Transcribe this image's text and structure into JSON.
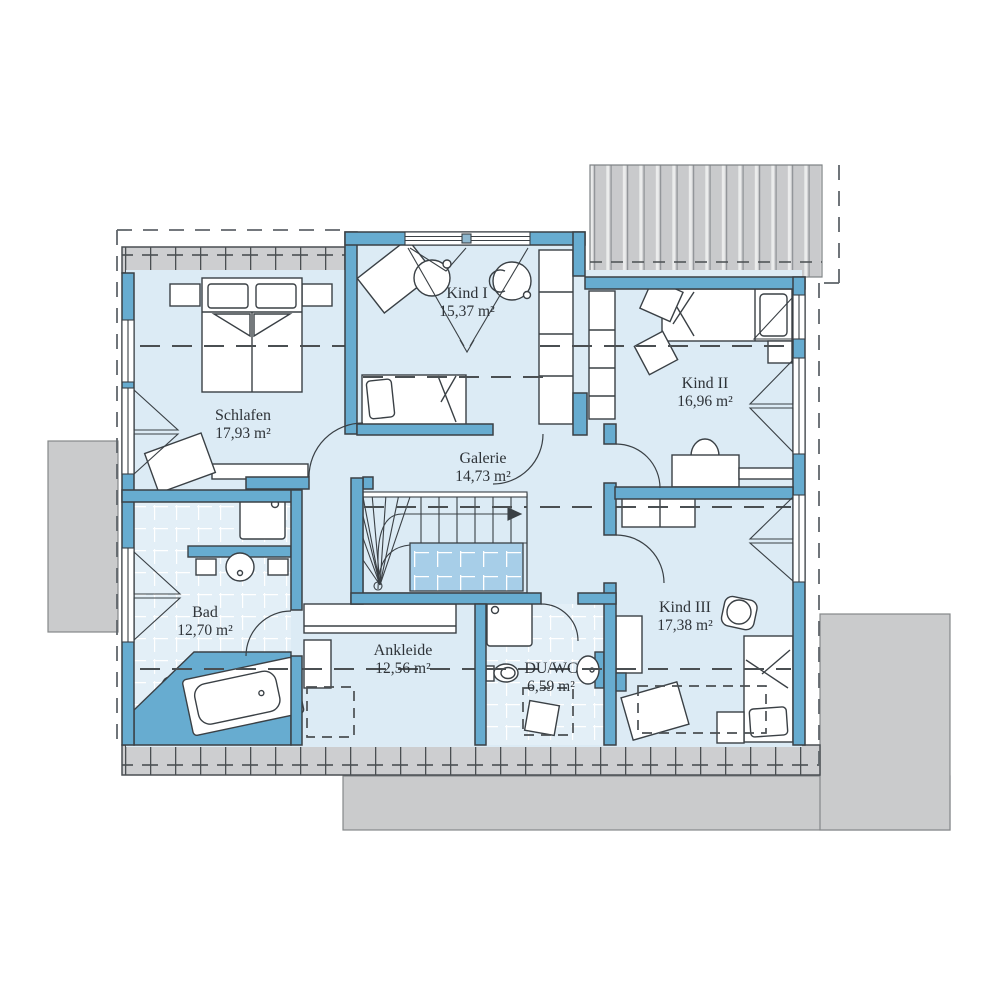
{
  "floorplan": {
    "rooms": {
      "schlafen": {
        "name": "Schlafen",
        "area": "17,93 m²"
      },
      "kind1": {
        "name": "Kind I",
        "area": "15,37 m²"
      },
      "kind2": {
        "name": "Kind II",
        "area": "16,96 m²"
      },
      "galerie": {
        "name": "Galerie",
        "area": "14,73 m²"
      },
      "bad": {
        "name": "Bad",
        "area": "12,70 m²"
      },
      "ankleide": {
        "name": "Ankleide",
        "area": "12,56 m²"
      },
      "duwc": {
        "name": "DU/WC",
        "area": "6,59 m²"
      },
      "kind3": {
        "name": "Kind III",
        "area": "17,38 m²"
      }
    },
    "colors": {
      "wall": "#67acd0",
      "room": "#dcebf5",
      "tile_room": "#e3eff7",
      "stair_landing": "#a7cee8",
      "roof_gray": "#cacbcc",
      "outline": "#3a4045"
    }
  }
}
